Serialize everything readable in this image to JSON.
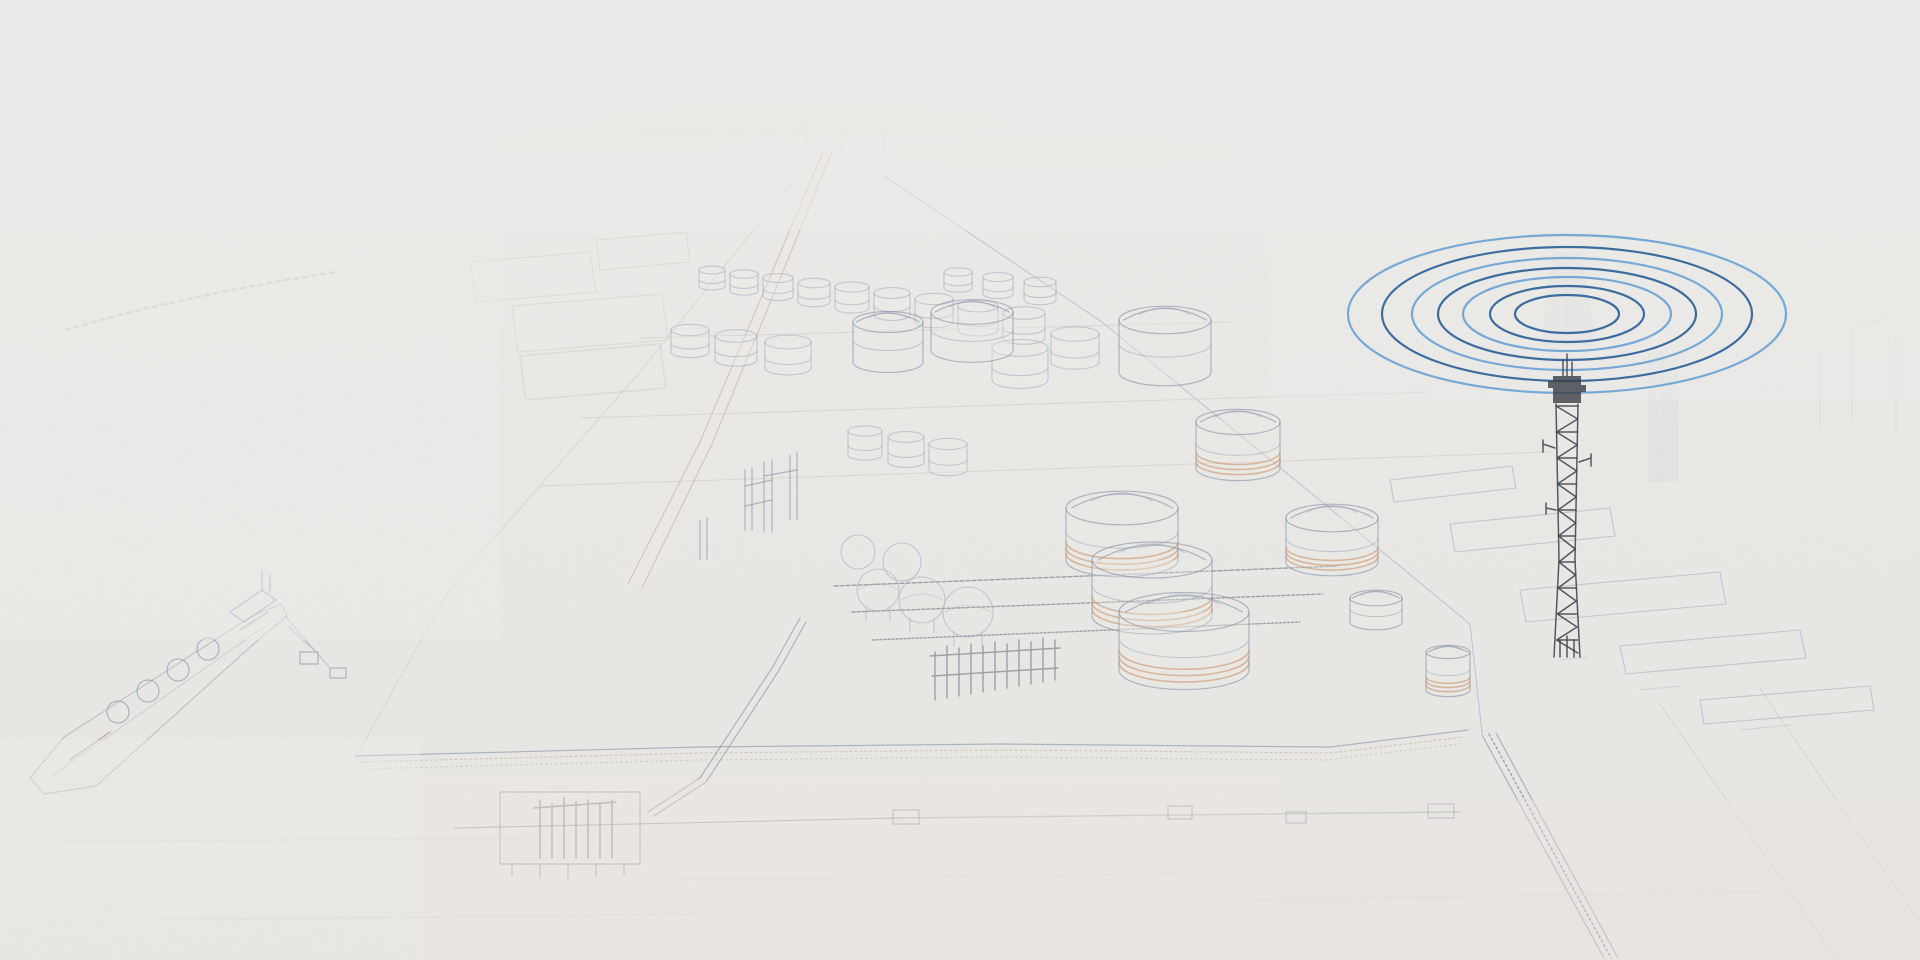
{
  "scene": {
    "description": "Faint pencil-sketch aerial view of a coastal LNG terminal with storage tanks, process units, jetties, a seawall and a moored LNG carrier; a crisp blue radio-signal graphic of concentric ellipses radiates from a dark communications tower on the right",
    "background": "#eae9e6",
    "fog": "#eeedeb",
    "water_pink": "#f4e9e2",
    "water_green": "#ebeeea"
  },
  "overlay": {
    "signal_rings": {
      "cx": 1567,
      "cy": 314,
      "stroke_width": 2.2,
      "colors": {
        "light": "#74a9d8",
        "dark": "#3a6b9e"
      },
      "rings": [
        {
          "a": 219,
          "b": 79,
          "tone": "light"
        },
        {
          "a": 185,
          "b": 67,
          "tone": "dark"
        },
        {
          "a": 155,
          "b": 56,
          "tone": "light"
        },
        {
          "a": 129,
          "b": 46,
          "tone": "dark"
        },
        {
          "a": 104,
          "b": 37,
          "tone": "light"
        },
        {
          "a": 77,
          "b": 28,
          "tone": "dark"
        },
        {
          "a": 52,
          "b": 19,
          "tone": "dark"
        }
      ]
    },
    "tower": {
      "x": 1567,
      "top": 373,
      "base": 657,
      "color": "#383c44"
    }
  },
  "illustration": {
    "palette": {
      "line_blue": "#8e9ab6",
      "line_slate": "#6d7a96",
      "line_brown": "#b99070",
      "line_orange": "#c4743f",
      "line_green": "#83a98c",
      "line_dark": "#4a5160",
      "ghost_gray": "#9aa0a8"
    },
    "large_tanks": [
      {
        "cx": 888,
        "cy": 362,
        "rx": 35,
        "h": 40,
        "stripes": false
      },
      {
        "cx": 972,
        "cy": 350,
        "rx": 41,
        "h": 38,
        "stripes": false
      },
      {
        "cx": 1165,
        "cy": 372,
        "rx": 46,
        "h": 52,
        "stripes": false
      },
      {
        "cx": 1238,
        "cy": 468,
        "rx": 42,
        "h": 46,
        "stripes": true
      },
      {
        "cx": 1122,
        "cy": 560,
        "rx": 56,
        "h": 52,
        "stripes": true
      },
      {
        "cx": 1152,
        "cy": 616,
        "rx": 60,
        "h": 56,
        "stripes": true
      },
      {
        "cx": 1184,
        "cy": 670,
        "rx": 65,
        "h": 58,
        "stripes": true
      },
      {
        "cx": 1332,
        "cy": 562,
        "rx": 46,
        "h": 44,
        "stripes": true
      },
      {
        "cx": 1376,
        "cy": 622,
        "rx": 26,
        "h": 24,
        "stripes": false
      },
      {
        "cx": 1448,
        "cy": 690,
        "rx": 22,
        "h": 38,
        "stripes": true
      }
    ],
    "small_tanks": [
      {
        "cx": 712,
        "cy": 286,
        "rx": 13,
        "h": 16
      },
      {
        "cx": 744,
        "cy": 291,
        "rx": 14,
        "h": 17
      },
      {
        "cx": 778,
        "cy": 296,
        "rx": 15,
        "h": 18
      },
      {
        "cx": 814,
        "cy": 302,
        "rx": 16,
        "h": 19
      },
      {
        "cx": 852,
        "cy": 308,
        "rx": 17,
        "h": 21
      },
      {
        "cx": 892,
        "cy": 315,
        "rx": 18,
        "h": 22
      },
      {
        "cx": 934,
        "cy": 322,
        "rx": 19,
        "h": 23
      },
      {
        "cx": 978,
        "cy": 330,
        "rx": 20,
        "h": 24
      },
      {
        "cx": 1024,
        "cy": 338,
        "rx": 21,
        "h": 25
      },
      {
        "cx": 1040,
        "cy": 300,
        "rx": 16,
        "h": 18
      },
      {
        "cx": 998,
        "cy": 294,
        "rx": 15,
        "h": 17
      },
      {
        "cx": 958,
        "cy": 288,
        "rx": 14,
        "h": 16
      },
      {
        "cx": 690,
        "cy": 352,
        "rx": 19,
        "h": 22
      },
      {
        "cx": 736,
        "cy": 360,
        "rx": 21,
        "h": 24
      },
      {
        "cx": 788,
        "cy": 368,
        "rx": 23,
        "h": 26
      },
      {
        "cx": 865,
        "cy": 455,
        "rx": 17,
        "h": 24
      },
      {
        "cx": 906,
        "cy": 462,
        "rx": 18,
        "h": 25
      },
      {
        "cx": 948,
        "cy": 470,
        "rx": 19,
        "h": 26
      },
      {
        "cx": 1075,
        "cy": 362,
        "rx": 24,
        "h": 28
      },
      {
        "cx": 1020,
        "cy": 380,
        "rx": 28,
        "h": 32
      }
    ]
  }
}
